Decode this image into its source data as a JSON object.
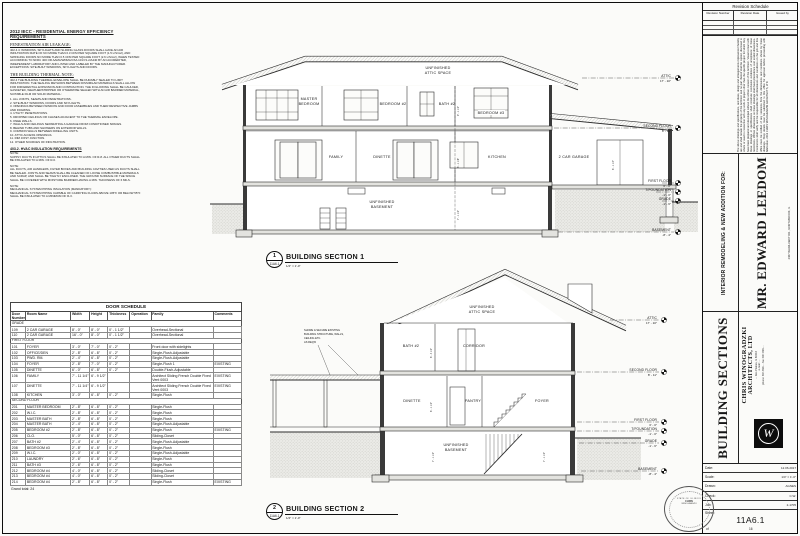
{
  "notes": {
    "title": "2012 IECC - RESIDENTIAL ENERGY EFFICIENCY REQUIREMENTS",
    "fenestration_heading": "FENESTRATION AIR LEAKAGE:",
    "fenestration_body": "402.4.4: WINDOWS, SKYLIGHTS AND SLIDING GLASS DOORS SHALL HAVE AN AIR INFILTRATION RATE OF NO MORE THAN 0.3 CFM PER SQUARE FOOT (1.5 L/S/m2), AND SWINGING DOORS NO MORE THAN 0.5 CFM PER SQUARE FOOT (2.6 L/S/m2), WHEN TESTED ACCORDING TO NFRC 400 OR AAMA/WDMA/CSA 101/I.S.2/A440 BY AN ACCREDITED, INDEPENDENT LABORATORY AND LISTED AND LABELED BY THE MANUFACTURER.\nEXCEPTIONS: SITE-BUILT WINDOWS, SKYLIGHTS AND DOORS.",
    "thermal_heading": "THE BUILDING THERMAL NOTE:",
    "thermal_body": "402.4 THE BUILDING THERMAL ENVELOPE SHALL BE DURABLY SEALED TO LIMIT INFILTRATION. THE SEALING METHODS BETWEEN DISSIMILAR MATERIALS SHALL ALLOW FOR DIFFERENTIAL EXPANSION AND CONTRACTION. THE FOLLOWING SHALL BE CAULKED, GASKETED, WEATHERSTRIPPED OR OTHERWISE SEALED WITH AN AIR BARRIER MATERIAL, SUITABLE FILM OR SOLID MATERIAL:",
    "thermal_list": "1. ALL JOINTS, SEAMS AND PENETRATIONS.\n2. SITE-BUILT WINDOWS, DOORS AND SKYLIGHTS.\n3. OPENINGS BETWEEN WINDOW AND DOOR ASSEMBLIES AND THEIR RESPECTIVE JAMBS AND FRAMING.\n4. UTILITY PENETRATIONS.\n5. DROPPED CEILINGS OR CHASES ADJACENT TO THE THERMAL ENVELOPE.\n6. KNEE WALLS.\n7. WALLS AND CEILINGS SEPARATING A GARAGE FROM CONDITIONED SPACES.\n8. BEHIND TUBS AND SHOWERS ON EXTERIOR WALLS.\n9. COMMON WALLS BETWEEN DWELLING UNITS.\n10. ATTIC ACCESS OPENINGS.\n11. RIM JOIST JUNCTION.\n12. OTHER SOURCES OF INFILTRATION.",
    "hvac_heading": "403.2. HVAC INSULATION REQUIREMENTS",
    "note1": "NOTE:\nSUPPLY DUCTS IN ATTICS SHALL BE INSULATED TO A MIN. OF R-8. ALL OTHER DUCTS SHALL BE INSULATED TO A MIN. OF R-6.",
    "note2": "NOTE:\nALL DUCTS, AIR HANDLERS, FILTER BOXES AND BUILDING CAVITIES USED AS DUCTS SHALL BE SEALED. JOINTS AND SEAMS SHALL BE CLEANED OF LOOSE COMBUSTIBLE MATERIALS AND SCRAP, AND SHALL BE TIGHTLY ENCLOSED. THE GROUND SURFACE OF THE SPACE SHALL BE COVERED WITH MOISTURE BARRIER HAVING A MIN. THICKNESS OF 6 MILS.",
    "note3": "NOTE:\nMECHANICAL SYSTEM PIPING INSULATION (MANDATORY):\nMECHANICAL SYSTEM PIPING CAPABLE OF CARRYING FLUIDS ABOVE 105°F OR BELOW 55°F SHALL BE INSULATED TO A MINIMUM OF R-3."
  },
  "door_schedule": {
    "title": "DOOR SCHEDULE",
    "columns": [
      "Door Number",
      "Room Name",
      "Width",
      "Height",
      "Thickness",
      "Operation",
      "Family",
      "Comments"
    ],
    "groups": [
      {
        "name": "GRADE",
        "rows": [
          [
            "109",
            "2 CAR GARAGE",
            "8' - 0\"",
            "8' - 0\"",
            "0' - 1 1/2\"",
            "",
            "Overhead-Sectional",
            ""
          ],
          [
            "110",
            "2 CAR GARAGE",
            "16' - 0\"",
            "8' - 0\"",
            "0' - 1 1/2\"",
            "",
            "Overhead-Sectional",
            ""
          ]
        ]
      },
      {
        "name": "FIRST FLOOR",
        "rows": [
          [
            "101",
            "FOYER",
            "3' - 0\"",
            "7' - 0\"",
            "0' - 2\"",
            "",
            "Front door with sidelights",
            ""
          ],
          [
            "102",
            "OFFICE/DEN",
            "2' - 8\"",
            "6' - 8\"",
            "0' - 2\"",
            "",
            "Single-Flush-Adjustable",
            ""
          ],
          [
            "103",
            "PWD. RM.",
            "2' - 4\"",
            "6' - 8\"",
            "0' - 2\"",
            "",
            "Single-Flush-Adjustable",
            ""
          ],
          [
            "104",
            "FOYER",
            "2' - 8\"",
            "7' - 0\"",
            "0' - 2\"",
            "",
            "Single-Flush 1",
            "EXISTING"
          ],
          [
            "105",
            "DINETTE",
            "6' - 0\"",
            "6' - 8\"",
            "0' - 2\"",
            "",
            "Double-Flush-Adjustable",
            ""
          ],
          [
            "106",
            "FAMILY",
            "7' - 11 1/4\"",
            "6' - 9 1/2\"",
            "",
            "",
            "Architect Sliding French Double Fixed Vent 0003",
            "EXISTING"
          ],
          [
            "107",
            "DINETTE",
            "7' - 11 1/4\"",
            "6' - 9 1/2\"",
            "",
            "",
            "Architect Sliding French Double Fixed Vent 0003",
            "EXISTING"
          ],
          [
            "108",
            "KITCHEN",
            "3' - 0\"",
            "6' - 8\"",
            "0' - 2\"",
            "",
            "Single-Flush",
            ""
          ]
        ]
      },
      {
        "name": "SECOND FLOOR",
        "rows": [
          [
            "201",
            "MASTER BEDROOM",
            "2' - 8\"",
            "6' - 8\"",
            "0' - 2\"",
            "",
            "Single-Flush",
            ""
          ],
          [
            "202",
            "W.I.C.",
            "2' - 8\"",
            "6' - 8\"",
            "0' - 2\"",
            "",
            "Single-Flush",
            ""
          ],
          [
            "203",
            "MASTER BATH",
            "2' - 8\"",
            "6' - 8\"",
            "0' - 2\"",
            "",
            "Single-Flush",
            ""
          ],
          [
            "204",
            "MASTER BATH",
            "2' - 4\"",
            "6' - 8\"",
            "0' - 2\"",
            "",
            "Single-Flush-Adjustable",
            ""
          ],
          [
            "205",
            "BEDROOM #2",
            "2' - 8\"",
            "6' - 8\"",
            "0' - 2\"",
            "",
            "Single-Flush",
            "EXISTING"
          ],
          [
            "206",
            "CLO.",
            "5' - 0\"",
            "6' - 8\"",
            "0' - 2\"",
            "",
            "Sliding-Closet",
            ""
          ],
          [
            "207",
            "BATH #2",
            "2' - 4\"",
            "6' - 8\"",
            "0' - 2\"",
            "",
            "Single-Flush-Adjustable",
            ""
          ],
          [
            "208",
            "BEDROOM #3",
            "2' - 8\"",
            "6' - 8\"",
            "0' - 2\"",
            "",
            "Single-Flush",
            ""
          ],
          [
            "209",
            "W.I.C.",
            "2' - 0\"",
            "6' - 8\"",
            "0' - 2\"",
            "",
            "Single-Flush-Adjustable",
            ""
          ],
          [
            "210",
            "LAUNDRY",
            "2' - 6\"",
            "6' - 8\"",
            "0' - 2\"",
            "",
            "Single-Flush",
            ""
          ],
          [
            "211",
            "BATH #3",
            "2' - 6\"",
            "6' - 8\"",
            "0' - 2\"",
            "",
            "Single-Flush",
            ""
          ],
          [
            "212",
            "BEDROOM #4",
            "4' - 0\"",
            "6' - 8\"",
            "0' - 2\"",
            "",
            "Sliding-Closet",
            ""
          ],
          [
            "213",
            "BEDROOM #4",
            "4' - 0\"",
            "6' - 8\"",
            "0' - 2\"",
            "",
            "Sliding-Closet",
            ""
          ],
          [
            "214",
            "BEDROOM #4",
            "2' - 8\"",
            "6' - 8\"",
            "0' - 2\"",
            "",
            "Single-Flush",
            "EXISTING"
          ]
        ]
      }
    ],
    "grand_total": "Grand total: 24"
  },
  "section1": {
    "bubble": {
      "number": "1",
      "sheet": "11A6.1"
    },
    "title": "BUILDING SECTION 1",
    "scale": "1/4\" = 1'-0\"",
    "labels": {
      "attic": [
        "UNFINISHED",
        "ATTIC SPACE"
      ],
      "master": [
        "MASTER",
        "BEDROOM"
      ],
      "bedroom2": "BEDROOM #2",
      "bath2": "BATH #2",
      "bedroom3": "BEDROOM #3",
      "family": "FAMILY",
      "dinette": "DINETTE",
      "kitchen": "KITCHEN",
      "garage": "2 CAR GARAGE",
      "basement": [
        "UNFINISHED",
        "BASEMENT"
      ]
    },
    "dims": [
      "9' - 1 1/2\"",
      "8' - 1 1/8\"",
      "7' - 1 1/2\"",
      "8' - 1 1/4\""
    ],
    "levels": [
      {
        "label": "ATTIC",
        "elev": "17' - 10\""
      },
      {
        "label": "SECOND FLOOR",
        "elev": "8' - 11\""
      },
      {
        "label": "FIRST FLOOR",
        "elev": "0' - 0\""
      },
      {
        "label": "T/FOUNDATION",
        "elev": "-1' - 0\""
      },
      {
        "label": "GRADE",
        "elev": "-1' - 6\""
      },
      {
        "label": "BASEMENT",
        "elev": "-8' - 4\""
      }
    ]
  },
  "section2": {
    "bubble": {
      "number": "2",
      "sheet": "11A6.1"
    },
    "title": "BUILDING SECTION 2",
    "scale": "1/4\" = 1'-0\"",
    "labels": {
      "attic": [
        "UNFINISHED",
        "ATTIC SPACE"
      ],
      "bath2": "BATH #2",
      "corridor": "CORRIDOR",
      "dinette": "DINETTE",
      "pantry": "PANTRY",
      "foyer": "FOYER",
      "basement": [
        "UNFINISHED",
        "BASEMENT"
      ]
    },
    "annotation": [
      "SHORE & SECURE EXISTING",
      "BUILDING STRUCTURE, WALLS,",
      "CEILING ETC.",
      "AS REQ'D"
    ],
    "dims": [
      "8' - 4 1/2\"",
      "8' - 1 1/2\"",
      "7' - 1 1/2\"",
      "7' - 1 1/2\""
    ],
    "levels": [
      {
        "label": "ATTIC",
        "elev": "17' - 10\""
      },
      {
        "label": "SECOND FLOOR",
        "elev": "8' - 11\""
      },
      {
        "label": "FIRST FLOOR",
        "elev": "0' - 0\""
      },
      {
        "label": "T/FOUNDATION",
        "elev": "-1' - 0\""
      },
      {
        "label": "GRADE",
        "elev": "-1' - 6\""
      },
      {
        "label": "BASEMENT",
        "elev": "-8' - 4\""
      }
    ]
  },
  "titleblock": {
    "revision": {
      "title": "Revision Schedule",
      "columns": [
        "Revision Number",
        "Revision Date",
        "Issued by"
      ]
    },
    "disclaimer": "The above drawings and specifications, and ideas, design and arrangements represented thereby are and shall remain the property of the Architect and no part thereof shall be copied, disclosed to others or used in connection with any work or project other than the specific project for which they have been prepared and developed without the written consent of the Architect. Visual contact with these drawings or specifications shall constitute conclusive evidence of acceptance of these restrictions. Written dimensions on these drawings shall have precedence over scaled dimensions. Contractors shall verify and be responsible for all dimensions and conditions on the job and this office must be notified of any variations from the dimensions and conditions shown by these drawings. Shop details must be submitted to this office for approval before proceeding with fabrication.  2012  CHRIS WINOGRADZKI ARCHITECTS, LTD",
    "project_label": "INTERIOR REMODELING & NEW ADDITION FOR:",
    "client": "MR. EDWARD LEEDOM",
    "client_address": "2467 WHIRLAWAY DR., NORTHBROOK, IL",
    "drawing_title": "BUILDING SECTIONS",
    "firm": {
      "line1": "CHRIS WINOGRADZKI",
      "line2": "ARCHITECTS, LTD",
      "contact": [
        "... Des Plaines, IL 60016",
        "e-mail: ...",
        "phone: 847-699-...   fax: 847-699-..."
      ],
      "logo_letter": "W"
    },
    "fields": [
      {
        "label": "Date:",
        "value": "12.06.2017"
      },
      {
        "label": "Scale:",
        "value": "1/4\" = 1'-0\""
      },
      {
        "label": "Drawn:",
        "value": "AGNES"
      },
      {
        "label": "Check:",
        "value": "C.W."
      },
      {
        "label": "Job:",
        "value": "2-1705"
      }
    ],
    "sheet_label": "Sheet:",
    "sheet_number": "11A6.1",
    "of_label": "of",
    "sheet_count": "16",
    "stamp": {
      "ring": "STATE OF ILLINOIS",
      "line1": "CHRIS",
      "line2": "WINOGRADZKI"
    }
  }
}
